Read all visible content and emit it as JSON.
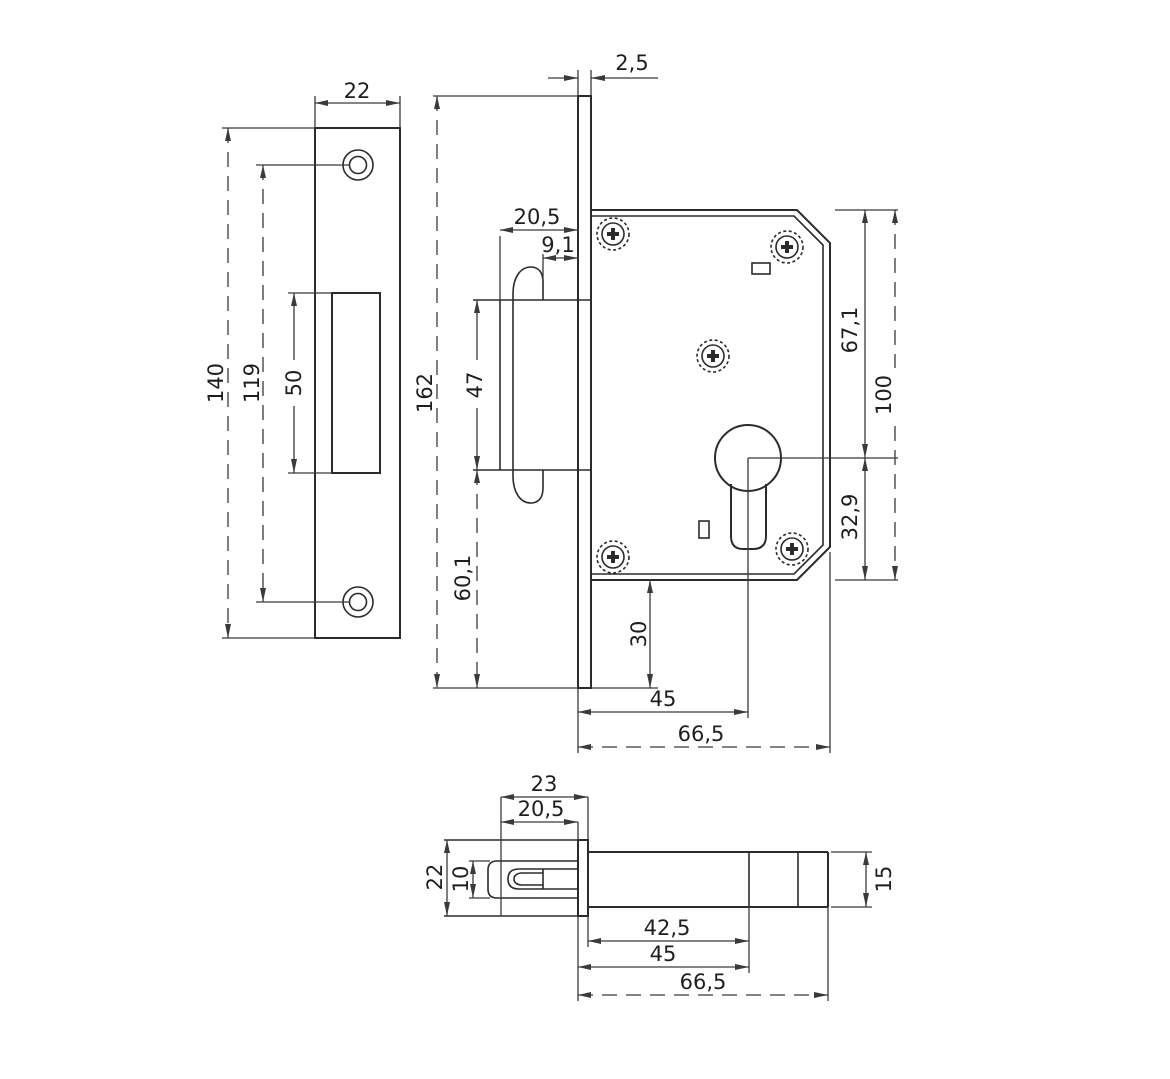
{
  "colors": {
    "line": "#2b2b2b",
    "dim_line": "#3a3a3a",
    "text": "#1e1e1e",
    "background": "#ffffff"
  },
  "views": {
    "strike_plate": {
      "dims": {
        "plate_width": "22",
        "plate_height": "140",
        "screw_hole_spacing": "119",
        "cutout_height": "50"
      }
    },
    "side": {
      "dims": {
        "faceplate_thickness": "2,5",
        "faceplate_height": "162",
        "bolt_protrusion": "20,5",
        "bolt_tip_offset": "9,1",
        "bolt_opening_height": "47",
        "bolt_to_plate_end": "60,1",
        "case_to_plate_end": "30",
        "backset": "45",
        "case_depth": "66,5",
        "case_top_to_cylinder": "67,1",
        "case_height": "100",
        "cylinder_to_case_bottom": "32,9"
      }
    },
    "plan": {
      "dims": {
        "bolt_protrusion_incl_plate": "23",
        "bolt_protrusion": "20,5",
        "plate_width": "22",
        "bolt_thickness": "10",
        "case_thickness": "15",
        "plate_back_to_cylinder": "42,5",
        "backset": "45",
        "case_depth": "66,5"
      }
    }
  }
}
